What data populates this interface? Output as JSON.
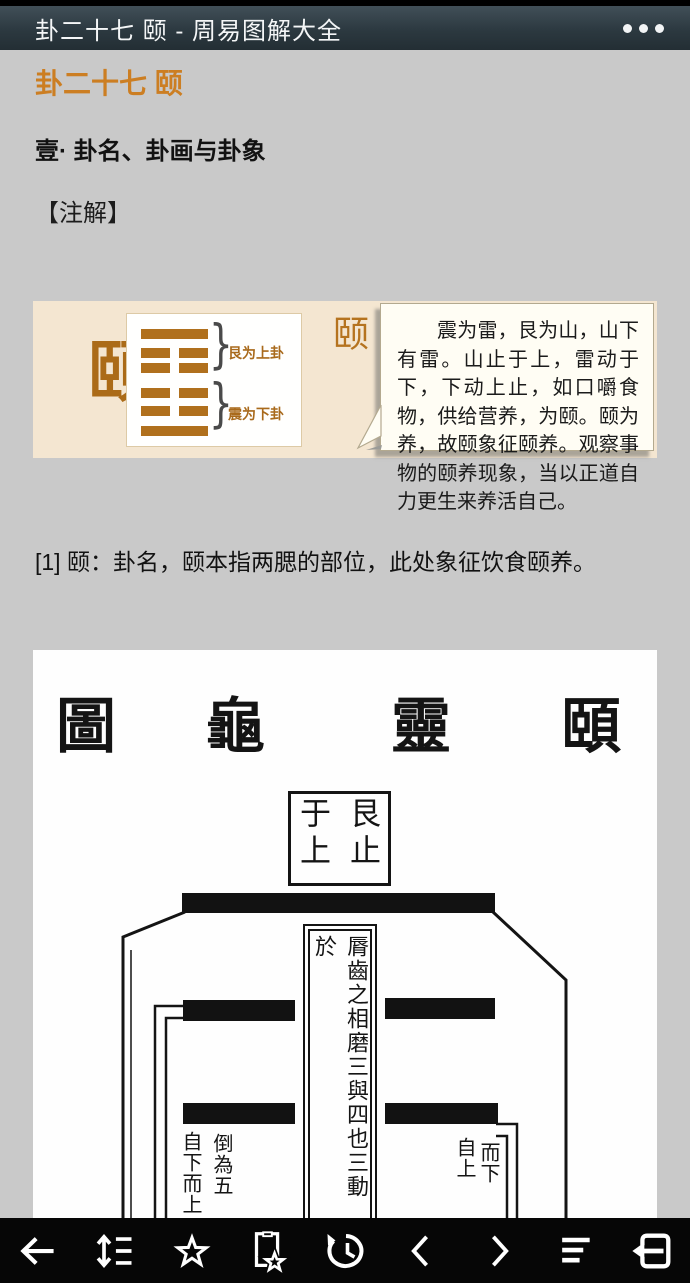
{
  "titlebar": {
    "title": "卦二十七 颐 - 周易图解大全",
    "menu_icon": "more-dots"
  },
  "article": {
    "heading": "卦二十七 颐",
    "section_heading": "壹· 卦名、卦画与卦象",
    "annotation_label": "【注解】",
    "footnote": "[1] 颐：卦名，颐本指两腮的部位，此处象征饮食颐养。"
  },
  "hexagram_panel": {
    "name_char": "颐",
    "name_superscript": "[1]",
    "vertical_name": "山雷颐",
    "upper_trigram_label": "艮为上卦",
    "lower_trigram_label": "震为下卦",
    "brace_glyph": "}",
    "lines_top_to_bottom": [
      "solid",
      "broken",
      "broken",
      "broken",
      "broken",
      "solid"
    ],
    "bubble_text": "震为雷，艮为山，山下有雷。山止于上，雷动于下，下动上止，如口嚼食物，供给营养，为颐。颐为养，故颐象征颐养。观察事物的颐养现象，当以正道自力更生来养活自己。",
    "colors": {
      "panel_bg": "#f4e6d1",
      "accent_brown": "#b5731f",
      "heading_orange": "#cc7e22"
    }
  },
  "diagram": {
    "title_chars": [
      "圖",
      "龜",
      "靈",
      "頤"
    ],
    "top_box_text": "艮止于上",
    "center_column_text": "脣齒之相磨三與四也三動於",
    "left_label_outer_col": "自下而上",
    "left_label_inner_col": "倒為五",
    "right_label_left_col": "自上",
    "right_label_right_col": "而下"
  },
  "toolbar": {
    "icons": [
      "back-arrow",
      "line-spacing",
      "favorite-star",
      "add-bookmark",
      "history",
      "previous-page",
      "next-page",
      "contents",
      "exit-reader"
    ]
  }
}
